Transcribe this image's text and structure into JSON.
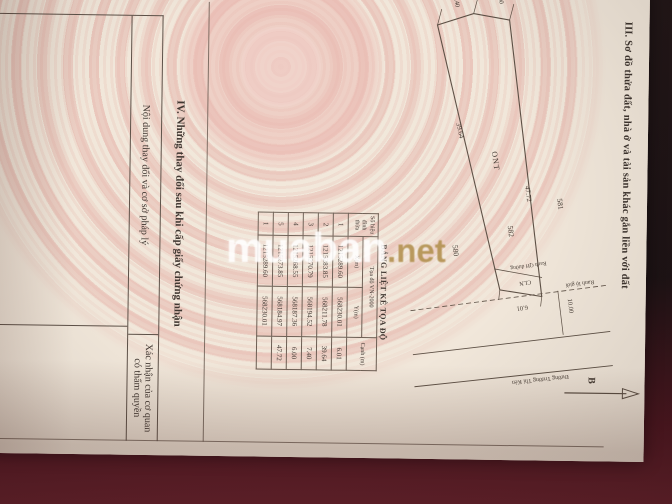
{
  "watermark": {
    "name": "muaban",
    "tld": ".net"
  },
  "section3": {
    "heading": "III. Sơ đồ thửa đất, nhà ở và tài sản khác gắn liền với đất",
    "diagram": {
      "north_label": "B",
      "parcel_581": "581",
      "parcel_582": "582",
      "parcel_580": "580",
      "ont": "ONT",
      "cln": "CLN",
      "dim_600": "6.00",
      "dim_740": "7.40",
      "dim_3964": "39.64",
      "dim_4772": "47.72",
      "dim_601": "6.01",
      "dim_1000": "10.00",
      "ranh_qh": "Ranh QH đường",
      "ranh_lo_gioi": "Ranh lộ giới",
      "road_name": "Đường Trường Thi Kèn"
    },
    "table": {
      "title": "BẢNG LIỆT KÊ TỌA ĐỘ",
      "col_vertex": "Số hiệu đỉnh thửa",
      "col_coords": "Tọa độ VN-2000",
      "col_x": "X(m)",
      "col_y": "Y(m)",
      "col_edge": "Cạnh (m)",
      "rows": [
        {
          "id": "1",
          "x": "1215289.60",
          "y": "568230.01",
          "c": "6.01"
        },
        {
          "id": "2",
          "x": "1215283.85",
          "y": "568211.78",
          "c": "39.64"
        },
        {
          "id": "3",
          "x": "1215270.79",
          "y": "568194.52",
          "c": "7.40"
        },
        {
          "id": "4",
          "x": "1215268.55",
          "y": "568187.36",
          "c": "6.00"
        },
        {
          "id": "5",
          "x": "1215273.85",
          "y": "568184.97",
          "c": "47.72"
        },
        {
          "id": "1",
          "x": "1215289.60",
          "y": "568230.01",
          "c": ""
        }
      ]
    }
  },
  "section4": {
    "heading": "IV. Những thay đổi sau khi cấp giấy chứng nhận",
    "col1": "Nội dung thay đổi và cơ sở pháp lý",
    "col2": "Xác nhận của cơ quan có thẩm quyền"
  }
}
